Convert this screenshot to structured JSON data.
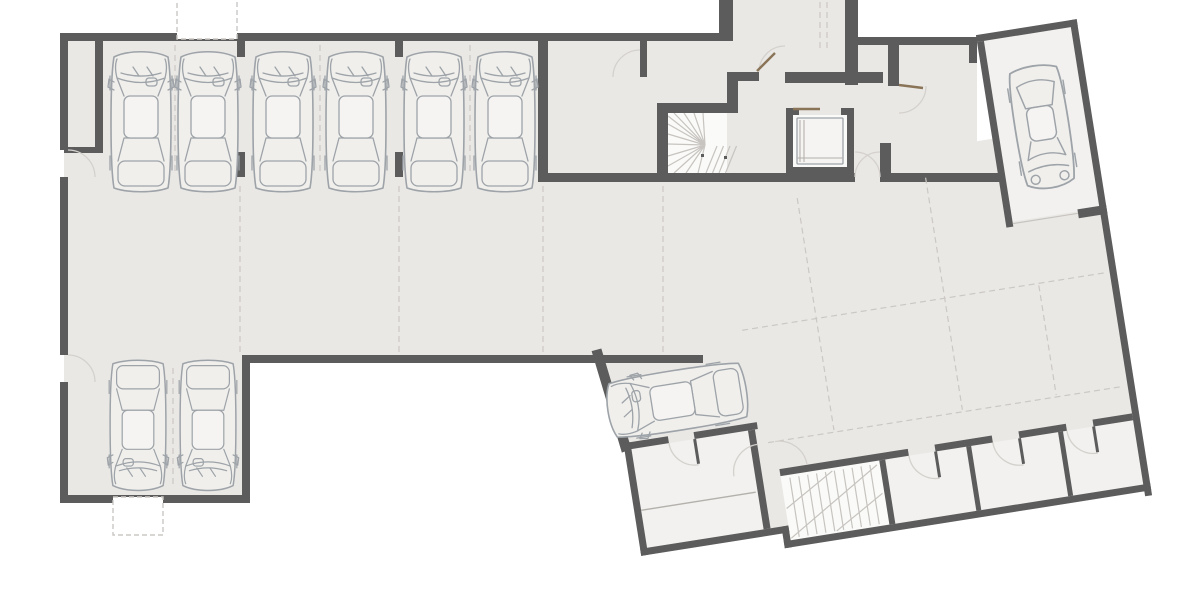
{
  "meta": {
    "description": "Top-down architectural floor plan of an underground parking level with parked cars, a winder staircase, an elevator, a private single-car garage in an angled wing, storage rooms and a second staircase",
    "drawing_type": "basement parking floor plan",
    "visible_text": ""
  },
  "colors": {
    "background": "#FFFFFF",
    "wall": "#5C5C5C",
    "floor": "#EAE8E5",
    "roomFill": "#F2F1EF",
    "stairFill": "#FAFAF8",
    "lineLight": "#C7C4C0",
    "lineMed": "#B4B1AC",
    "lineDash": "#CBC8C4",
    "arc": "#D4D1CD",
    "leaf": "#8A7458",
    "car": "#9DA3A8",
    "carFill": "#F0EFEC",
    "cabFill": "#F5F4F2"
  },
  "inventory": {
    "cars_top_row": 6,
    "cars_bottom_left": 2,
    "cars_private_garage": 1,
    "cars_drive_aisle": 1,
    "staircases": 2,
    "elevators": 1,
    "storage_rooms": 3,
    "door_swings": 12,
    "exterior_niches": 2,
    "angled_wing_rotation_deg": -9
  },
  "icons": {
    "car": "top-view car outline glyph",
    "stair": "radiating winder treads",
    "elevator": "shaft with cab symbol",
    "door": "quarter-circle swing arc"
  }
}
